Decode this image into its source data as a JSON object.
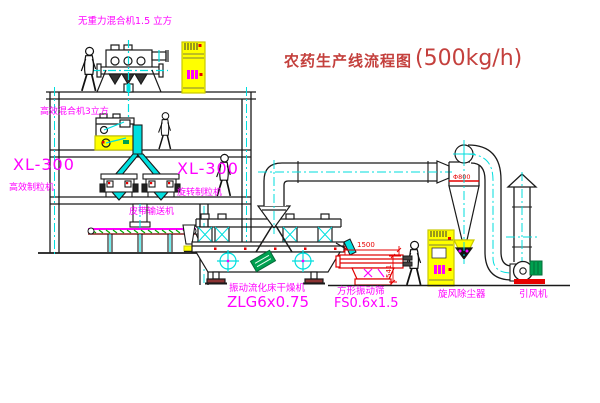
{
  "title": {
    "cn": "农药生产线流程图",
    "cap": "(500kg/h)"
  },
  "labels": {
    "gravity_mixer": "无重力混合机1.5 立方",
    "eff_mixer": "高效混合机3立方",
    "gran_left_model": "XL-300",
    "gran_left_name": "高效制粒机",
    "gran_mid_model": "XL-300",
    "gran_mid_name": "旋转制粒机",
    "belt": "皮带输送机",
    "dryer_name": "振动流化床干燥机",
    "dryer_model": "ZLG6x0.75",
    "screen_name": "方形振动筛",
    "screen_model": "FS0.6x1.5",
    "cyclone": "旋风除尘器",
    "fan": "引风机"
  },
  "dims": {
    "d1500": "1500",
    "d541": "541",
    "phi800": "Φ800"
  },
  "colors": {
    "label_magenta": "#ff00ff",
    "title_red": "#c4403d",
    "dim_red": "#e60000",
    "equipment_yellow": "#ffff00",
    "centerline_cyan": "#00dede",
    "machine_green": "#00a050"
  }
}
